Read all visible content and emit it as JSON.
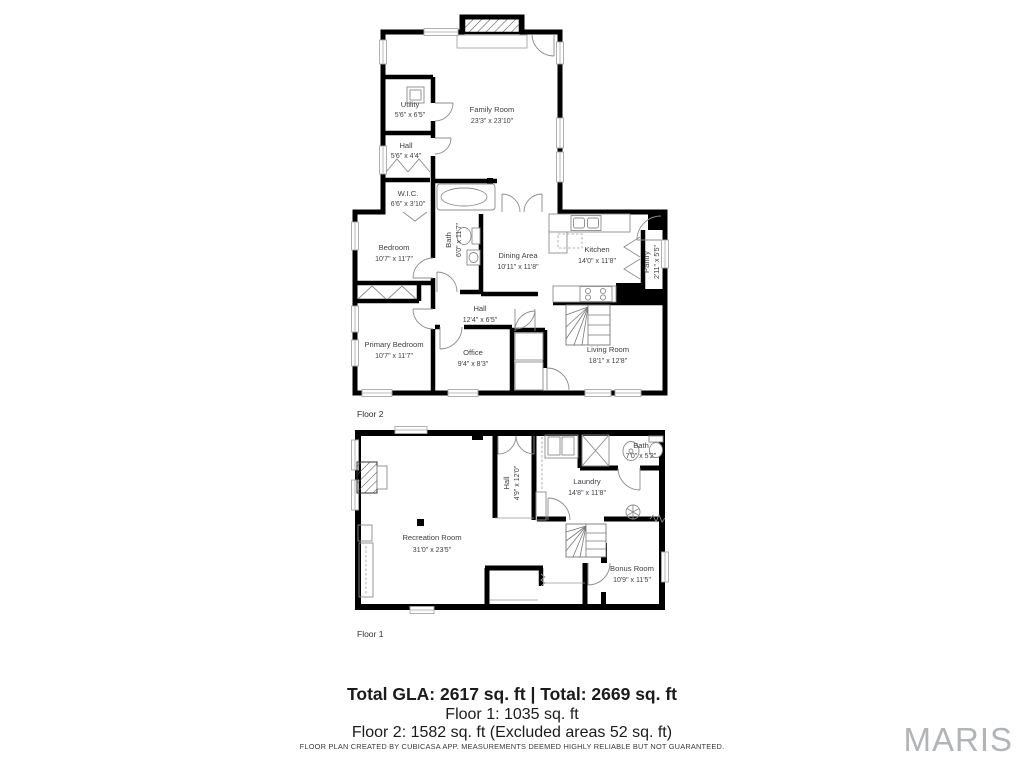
{
  "colors": {
    "wall": "#000000",
    "label": "#3f3f46",
    "watermark": "#b2b5b8"
  },
  "floor2": {
    "label": "Floor 2",
    "rooms": [
      {
        "name": "Family Room",
        "dims": "23'3\" x 23'10\""
      },
      {
        "name": "Utility",
        "dims": "5'6\" x 6'5\""
      },
      {
        "name": "Hall",
        "dims": "5'6\" x 4'4\""
      },
      {
        "name": "W.I.C.",
        "dims": "6'6\" x 3'10\""
      },
      {
        "name": "Bedroom",
        "dims": "10'7\" x 11'7\""
      },
      {
        "name": "Bath",
        "dims": "6'0\" x 11'7\""
      },
      {
        "name": "Dining Area",
        "dims": "10'11\" x 11'8\""
      },
      {
        "name": "Kitchen",
        "dims": "14'0\" x 11'8\""
      },
      {
        "name": "Pantry",
        "dims": "2'11\" x 5'5\""
      },
      {
        "name": "Hall",
        "dims": "12'4\" x 6'5\""
      },
      {
        "name": "Primary Bedroom",
        "dims": "10'7\" x 11'7\""
      },
      {
        "name": "Office",
        "dims": "9'4\" x 8'3\""
      },
      {
        "name": "Living Room",
        "dims": "18'1\" x 12'8\""
      }
    ]
  },
  "floor1": {
    "label": "Floor 1",
    "rooms": [
      {
        "name": "Recreation Room",
        "dims": "31'0\" x 23'5\""
      },
      {
        "name": "Hall",
        "dims": "4'9\" x 12'0\""
      },
      {
        "name": "Laundry",
        "dims": "14'8\" x 11'8\""
      },
      {
        "name": "Bath",
        "dims": "7'0\" x 5'2\""
      },
      {
        "name": "Bonus Room",
        "dims": "10'9\" x 11'5\""
      }
    ]
  },
  "footer": {
    "total_line": "Total GLA: 2617 sq. ft | Total: 2669 sq. ft",
    "floor1_line": "Floor 1: 1035 sq. ft",
    "floor2_line": "Floor 2: 1582 sq. ft (Excluded areas 52 sq. ft)",
    "disclaimer": "FLOOR PLAN CREATED BY CUBICASA APP. MEASUREMENTS DEEMED HIGHLY RELIABLE BUT NOT GUARANTEED."
  },
  "watermark": {
    "text": "MARIS"
  }
}
